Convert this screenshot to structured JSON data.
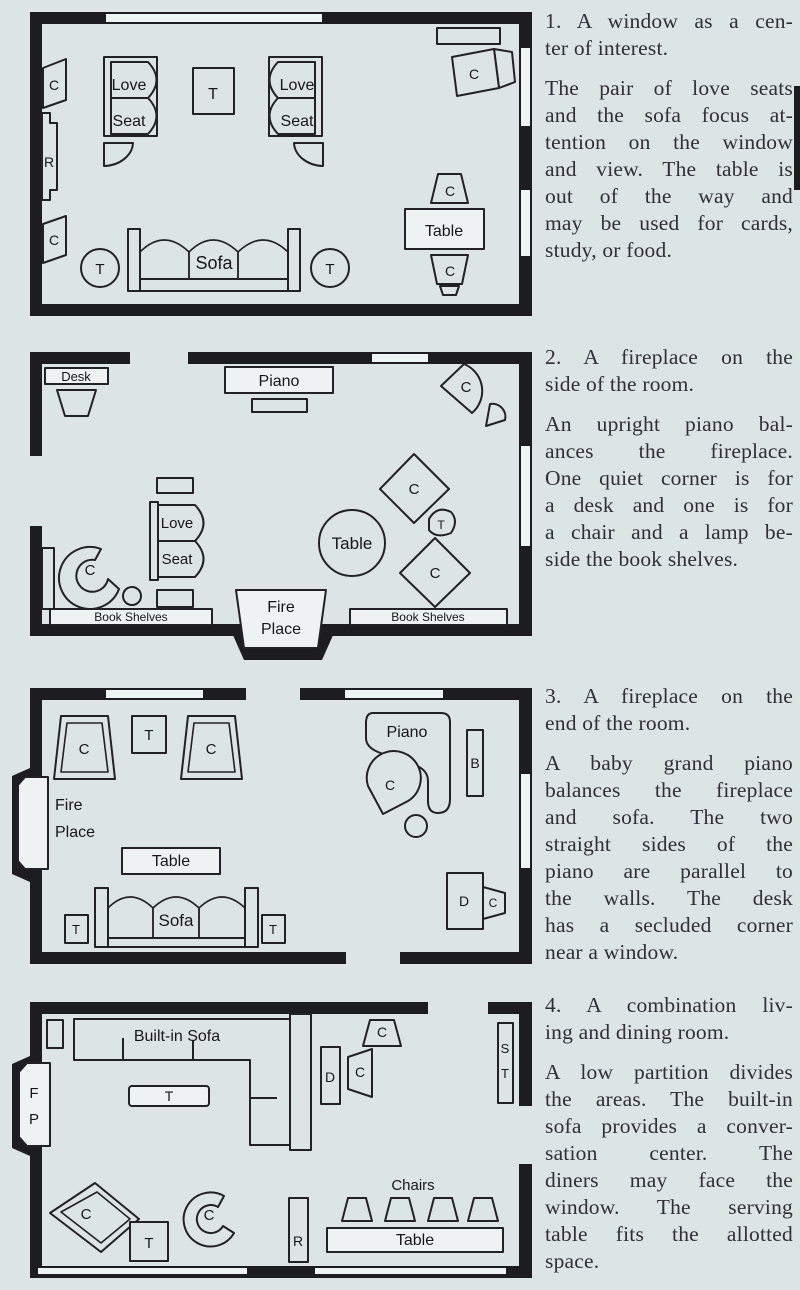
{
  "page": {
    "bg": "#dde4e5",
    "ink": "#1d1d21",
    "paper": "#eef2f2",
    "text_color": "#2f2f38"
  },
  "sections": [
    {
      "heading_lines": [
        "1. A window as a cen-",
        "ter of interest."
      ],
      "body_lines": [
        "The pair of love seats",
        "and the sofa focus at-",
        "tention on the window",
        "and view. The table is",
        "out of the way and",
        "may be used for cards,",
        "study, or food."
      ]
    },
    {
      "heading_lines": [
        "2. A fireplace on the",
        "side of the room."
      ],
      "body_lines": [
        "An upright piano bal-",
        "ances the fireplace.",
        "One quiet corner is for",
        "a desk and one is for",
        "a chair and a lamp be-",
        "side the book shelves."
      ]
    },
    {
      "heading_lines": [
        "3. A fireplace on the",
        "end of the room."
      ],
      "body_lines": [
        "A baby grand piano",
        "balances the fireplace",
        "and sofa. The two",
        "straight sides of the",
        "piano are parallel to",
        "the walls. The desk",
        "has a secluded corner",
        "near a window."
      ]
    },
    {
      "heading_lines": [
        "4. A combination liv-",
        "ing and dining room."
      ],
      "body_lines": [
        "A low partition divides",
        "the areas. The built-in",
        "sofa provides a conver-",
        "sation center. The",
        "diners may face the",
        "window. The serving",
        "table fits the allotted",
        "space."
      ]
    }
  ],
  "diagrams": {
    "d1": {
      "labels": {
        "chair": "C",
        "radio": "R",
        "love": "Love",
        "seat": "Seat",
        "small_table": "T",
        "sofa": "Sofa",
        "table": "Table"
      }
    },
    "d2": {
      "labels": {
        "desk": "Desk",
        "piano": "Piano",
        "chair": "C",
        "small_table": "T",
        "love": "Love",
        "seat": "Seat",
        "table": "Table",
        "book_shelves": "Book Shelves",
        "fire": "Fire",
        "place": "Place"
      }
    },
    "d3": {
      "labels": {
        "chair": "C",
        "small_table": "T",
        "fire": "Fire",
        "place": "Place",
        "table": "Table",
        "sofa": "Sofa",
        "piano": "Piano",
        "bench": "B",
        "desk": "D"
      }
    },
    "d4": {
      "labels": {
        "built_in_sofa": "Built-in Sofa",
        "small_table": "T",
        "fireplace_f": "F",
        "fireplace_p": "P",
        "chair": "C",
        "desk": "D",
        "serving_s": "S",
        "serving_t": "T",
        "radio": "R",
        "chairs": "Chairs",
        "table": "Table"
      }
    }
  }
}
